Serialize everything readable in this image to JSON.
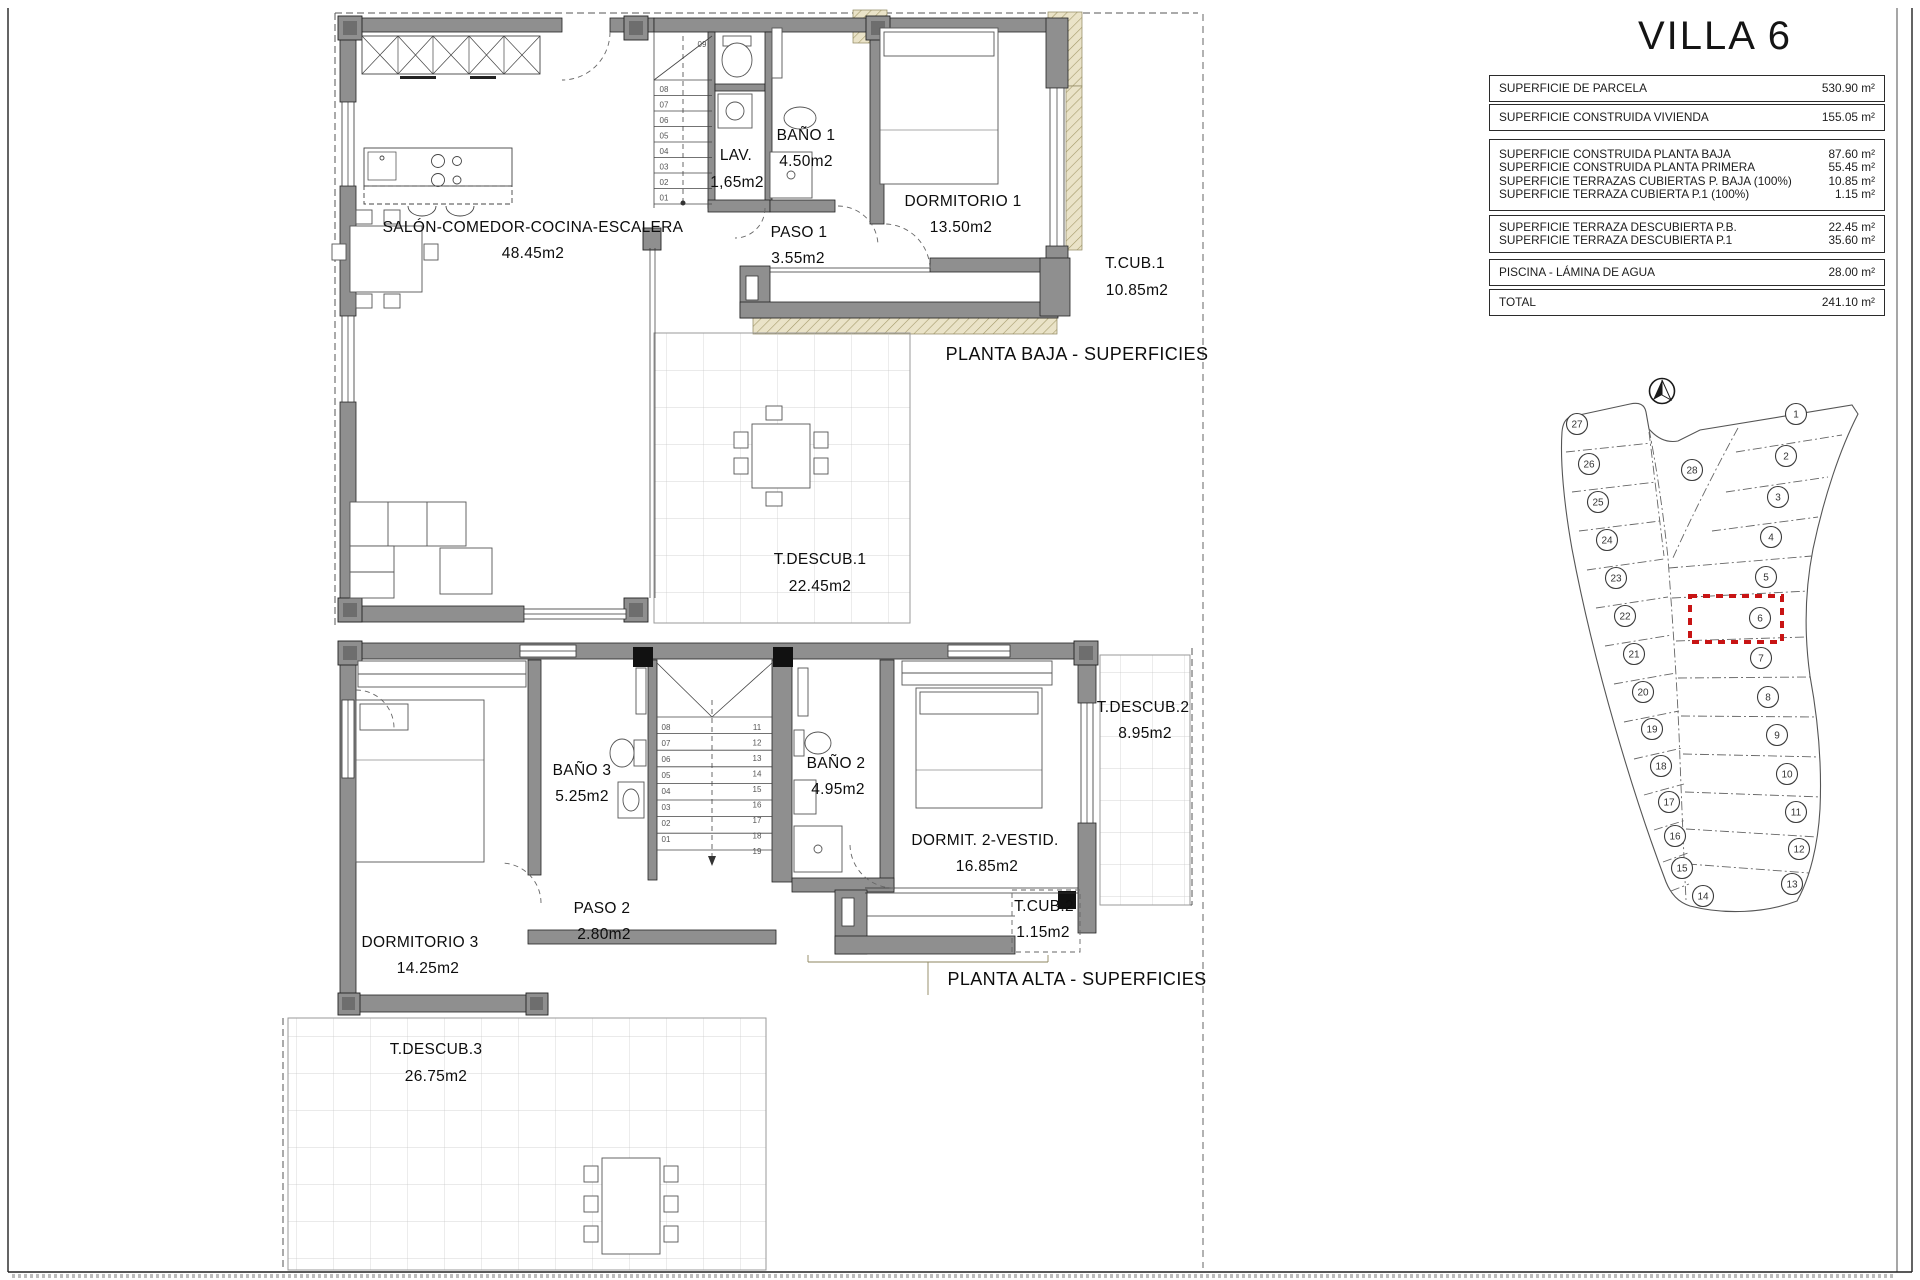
{
  "sheet": {
    "title": "VILLA 6"
  },
  "surface_table": {
    "groups": [
      {
        "rows": [
          {
            "label": "SUPERFICIE DE PARCELA",
            "value": "530.90 m²"
          }
        ]
      },
      {
        "rows": [
          {
            "label": "SUPERFICIE CONSTRUIDA VIVIENDA",
            "value": "155.05 m²"
          }
        ]
      },
      {
        "rows": [
          {
            "label": "SUPERFICIE CONSTRUIDA PLANTA BAJA",
            "value": "87.60 m²"
          },
          {
            "label": "SUPERFICIE CONSTRUIDA PLANTA PRIMERA",
            "value": "55.45 m²"
          },
          {
            "label": "SUPERFICIE TERRAZAS CUBIERTAS P. BAJA (100%)",
            "value": "10.85 m²"
          },
          {
            "label": "SUPERFICIE TERRAZA CUBIERTA P.1 (100%)",
            "value": "1.15 m²"
          }
        ]
      },
      {
        "rows": [
          {
            "label": "SUPERFICIE TERRAZA DESCUBIERTA P.B.",
            "value": "22.45 m²"
          },
          {
            "label": "SUPERFICIE TERRAZA DESCUBIERTA P.1",
            "value": "35.60 m²"
          }
        ]
      },
      {
        "rows": [
          {
            "label": "PISCINA - LÁMINA DE AGUA",
            "value": "28.00 m²"
          }
        ]
      },
      {
        "rows": [
          {
            "label": "TOTAL",
            "value": "241.10 m²"
          }
        ]
      }
    ]
  },
  "planta_baja": {
    "caption": "PLANTA BAJA - SUPERFICIES",
    "rooms": {
      "salon": {
        "name": "SALÓN-COMEDOR-COCINA-ESCALERA",
        "area": "48.45m2"
      },
      "lav": {
        "name": "LAV.",
        "area": "1,65m2"
      },
      "bano1": {
        "name": "BAÑO 1",
        "area": "4.50m2"
      },
      "paso1": {
        "name": "PASO 1",
        "area": "3.55m2"
      },
      "dormitorio1": {
        "name": "DORMITORIO 1",
        "area": "13.50m2"
      },
      "tcub1": {
        "name": "T.CUB.1",
        "area": "10.85m2"
      },
      "tdescub1": {
        "name": "T.DESCUB.1",
        "area": "22.45m2"
      }
    },
    "stairs": {
      "top": "09",
      "numbers": [
        "08",
        "07",
        "06",
        "05",
        "04",
        "03",
        "02",
        "01"
      ]
    }
  },
  "planta_alta": {
    "caption": "PLANTA ALTA - SUPERFICIES",
    "rooms": {
      "dormitorio3": {
        "name": "DORMITORIO 3",
        "area": "14.25m2"
      },
      "bano3": {
        "name": "BAÑO 3",
        "area": "5.25m2"
      },
      "paso2": {
        "name": "PASO 2",
        "area": "2.80m2"
      },
      "bano2": {
        "name": "BAÑO 2",
        "area": "4.95m2"
      },
      "dormitorio2": {
        "name": "DORMIT. 2-VESTID.",
        "area": "16.85m2"
      },
      "tdescub2": {
        "name": "T.DESCUB.2",
        "area": "8.95m2"
      },
      "tcub2": {
        "name": "T.CUB.2",
        "area": "1.15m2"
      },
      "tdescub3": {
        "name": "T.DESCUB.3",
        "area": "26.75m2"
      }
    },
    "stairs": {
      "left": [
        "08",
        "07",
        "06",
        "05",
        "04",
        "03",
        "02",
        "01"
      ],
      "right": [
        "11",
        "12",
        "13",
        "14",
        "15",
        "16",
        "17",
        "18",
        "19"
      ]
    }
  },
  "site_plan": {
    "highlighted_plot": "6",
    "plot_center": "28",
    "plot_bottom": "14",
    "plots_left": [
      "27",
      "26",
      "25",
      "24",
      "23",
      "22",
      "21",
      "20",
      "19",
      "18",
      "17",
      "16",
      "15"
    ],
    "plots_right": [
      "1",
      "2",
      "3",
      "4",
      "5",
      "6",
      "7",
      "8",
      "9",
      "10",
      "11",
      "12",
      "13"
    ]
  },
  "colors": {
    "wall": "#8f8f8f",
    "hatch_fill": "#eae3c8",
    "highlight": "#c81414"
  }
}
